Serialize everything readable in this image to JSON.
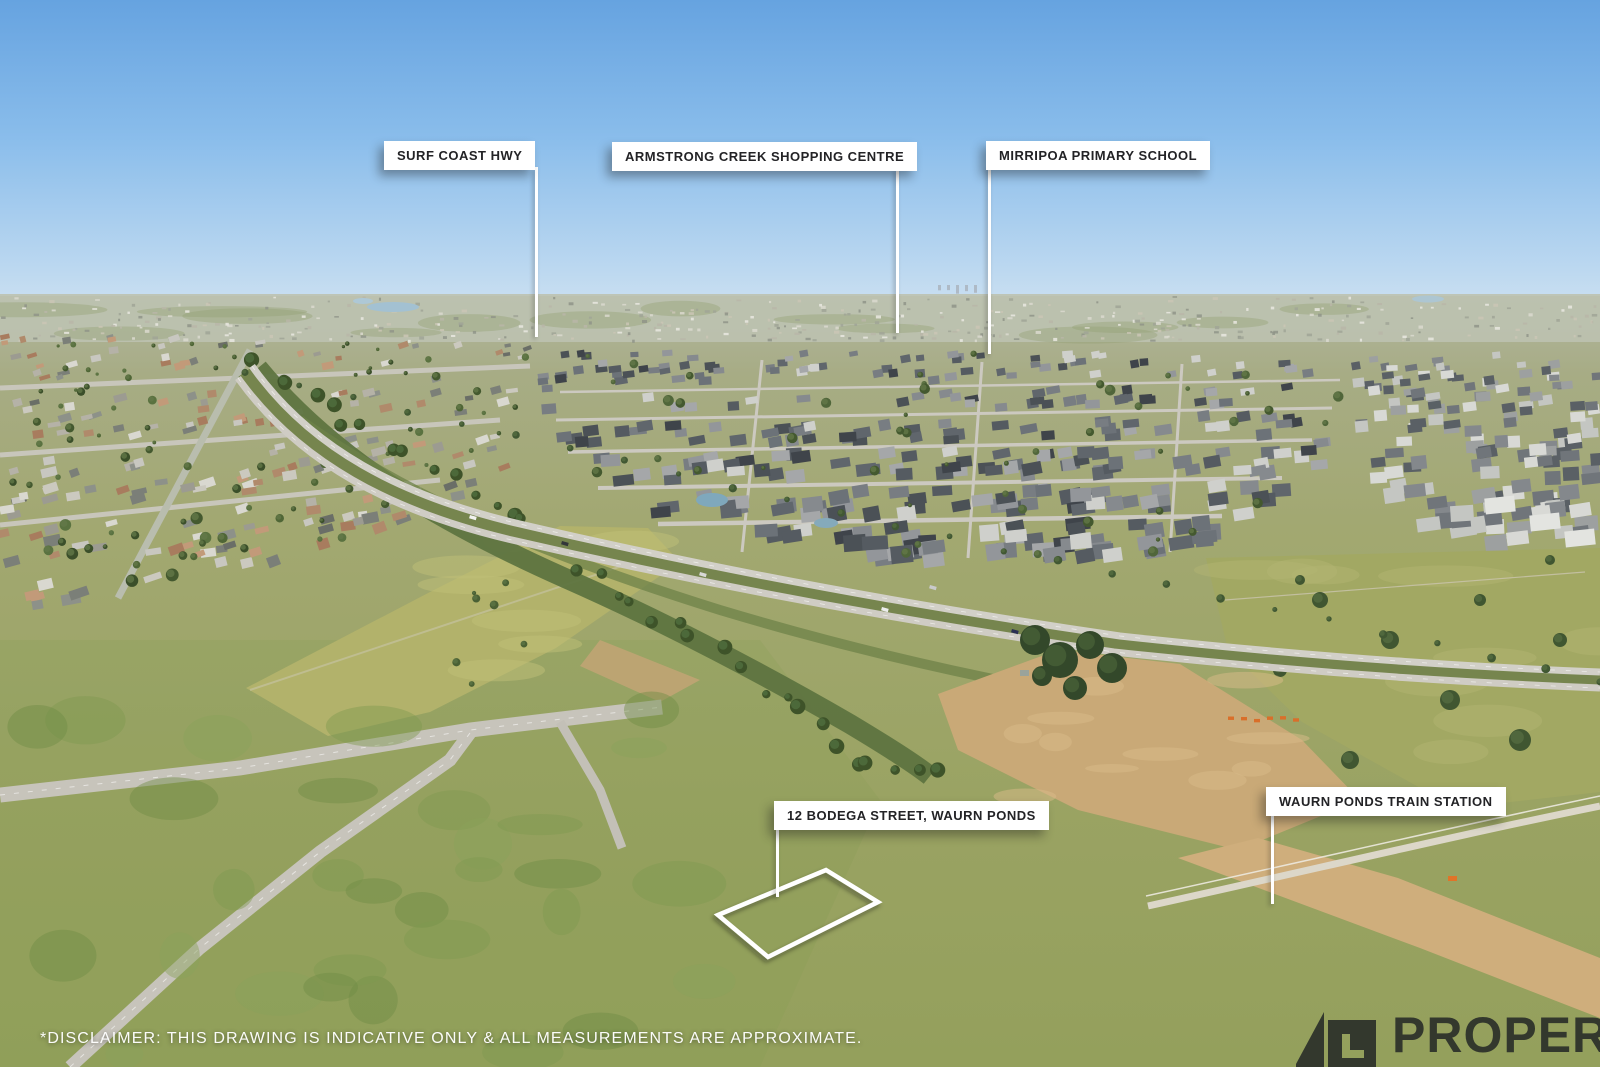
{
  "callouts": [
    {
      "id": "surf-coast-hwy",
      "label": "SURF COAST HWY"
    },
    {
      "id": "armstrong-creek-shopping-centre",
      "label": "ARMSTRONG CREEK SHOPPING CENTRE"
    },
    {
      "id": "mirripoa-primary-school",
      "label": "MIRRIPOA PRIMARY SCHOOL"
    },
    {
      "id": "subject-property",
      "label": "12 BODEGA STREET, WAURN PONDS"
    },
    {
      "id": "waurn-ponds-train-station",
      "label": "WAURN PONDS TRAIN STATION"
    }
  ],
  "disclaimer": "*DISCLAIMER: THIS DRAWING IS INDICATIVE ONLY & ALL MEASUREMENTS ARE APPROXIMATE.",
  "watermark": {
    "text": "PROPERTY"
  },
  "colors": {
    "label_background": "#ffffff",
    "label_text": "#232326",
    "leader_line": "#ffffff",
    "property_outline": "#ffffff",
    "disclaimer_text": "#ffffff",
    "watermark_mark": "#1a1e22"
  }
}
